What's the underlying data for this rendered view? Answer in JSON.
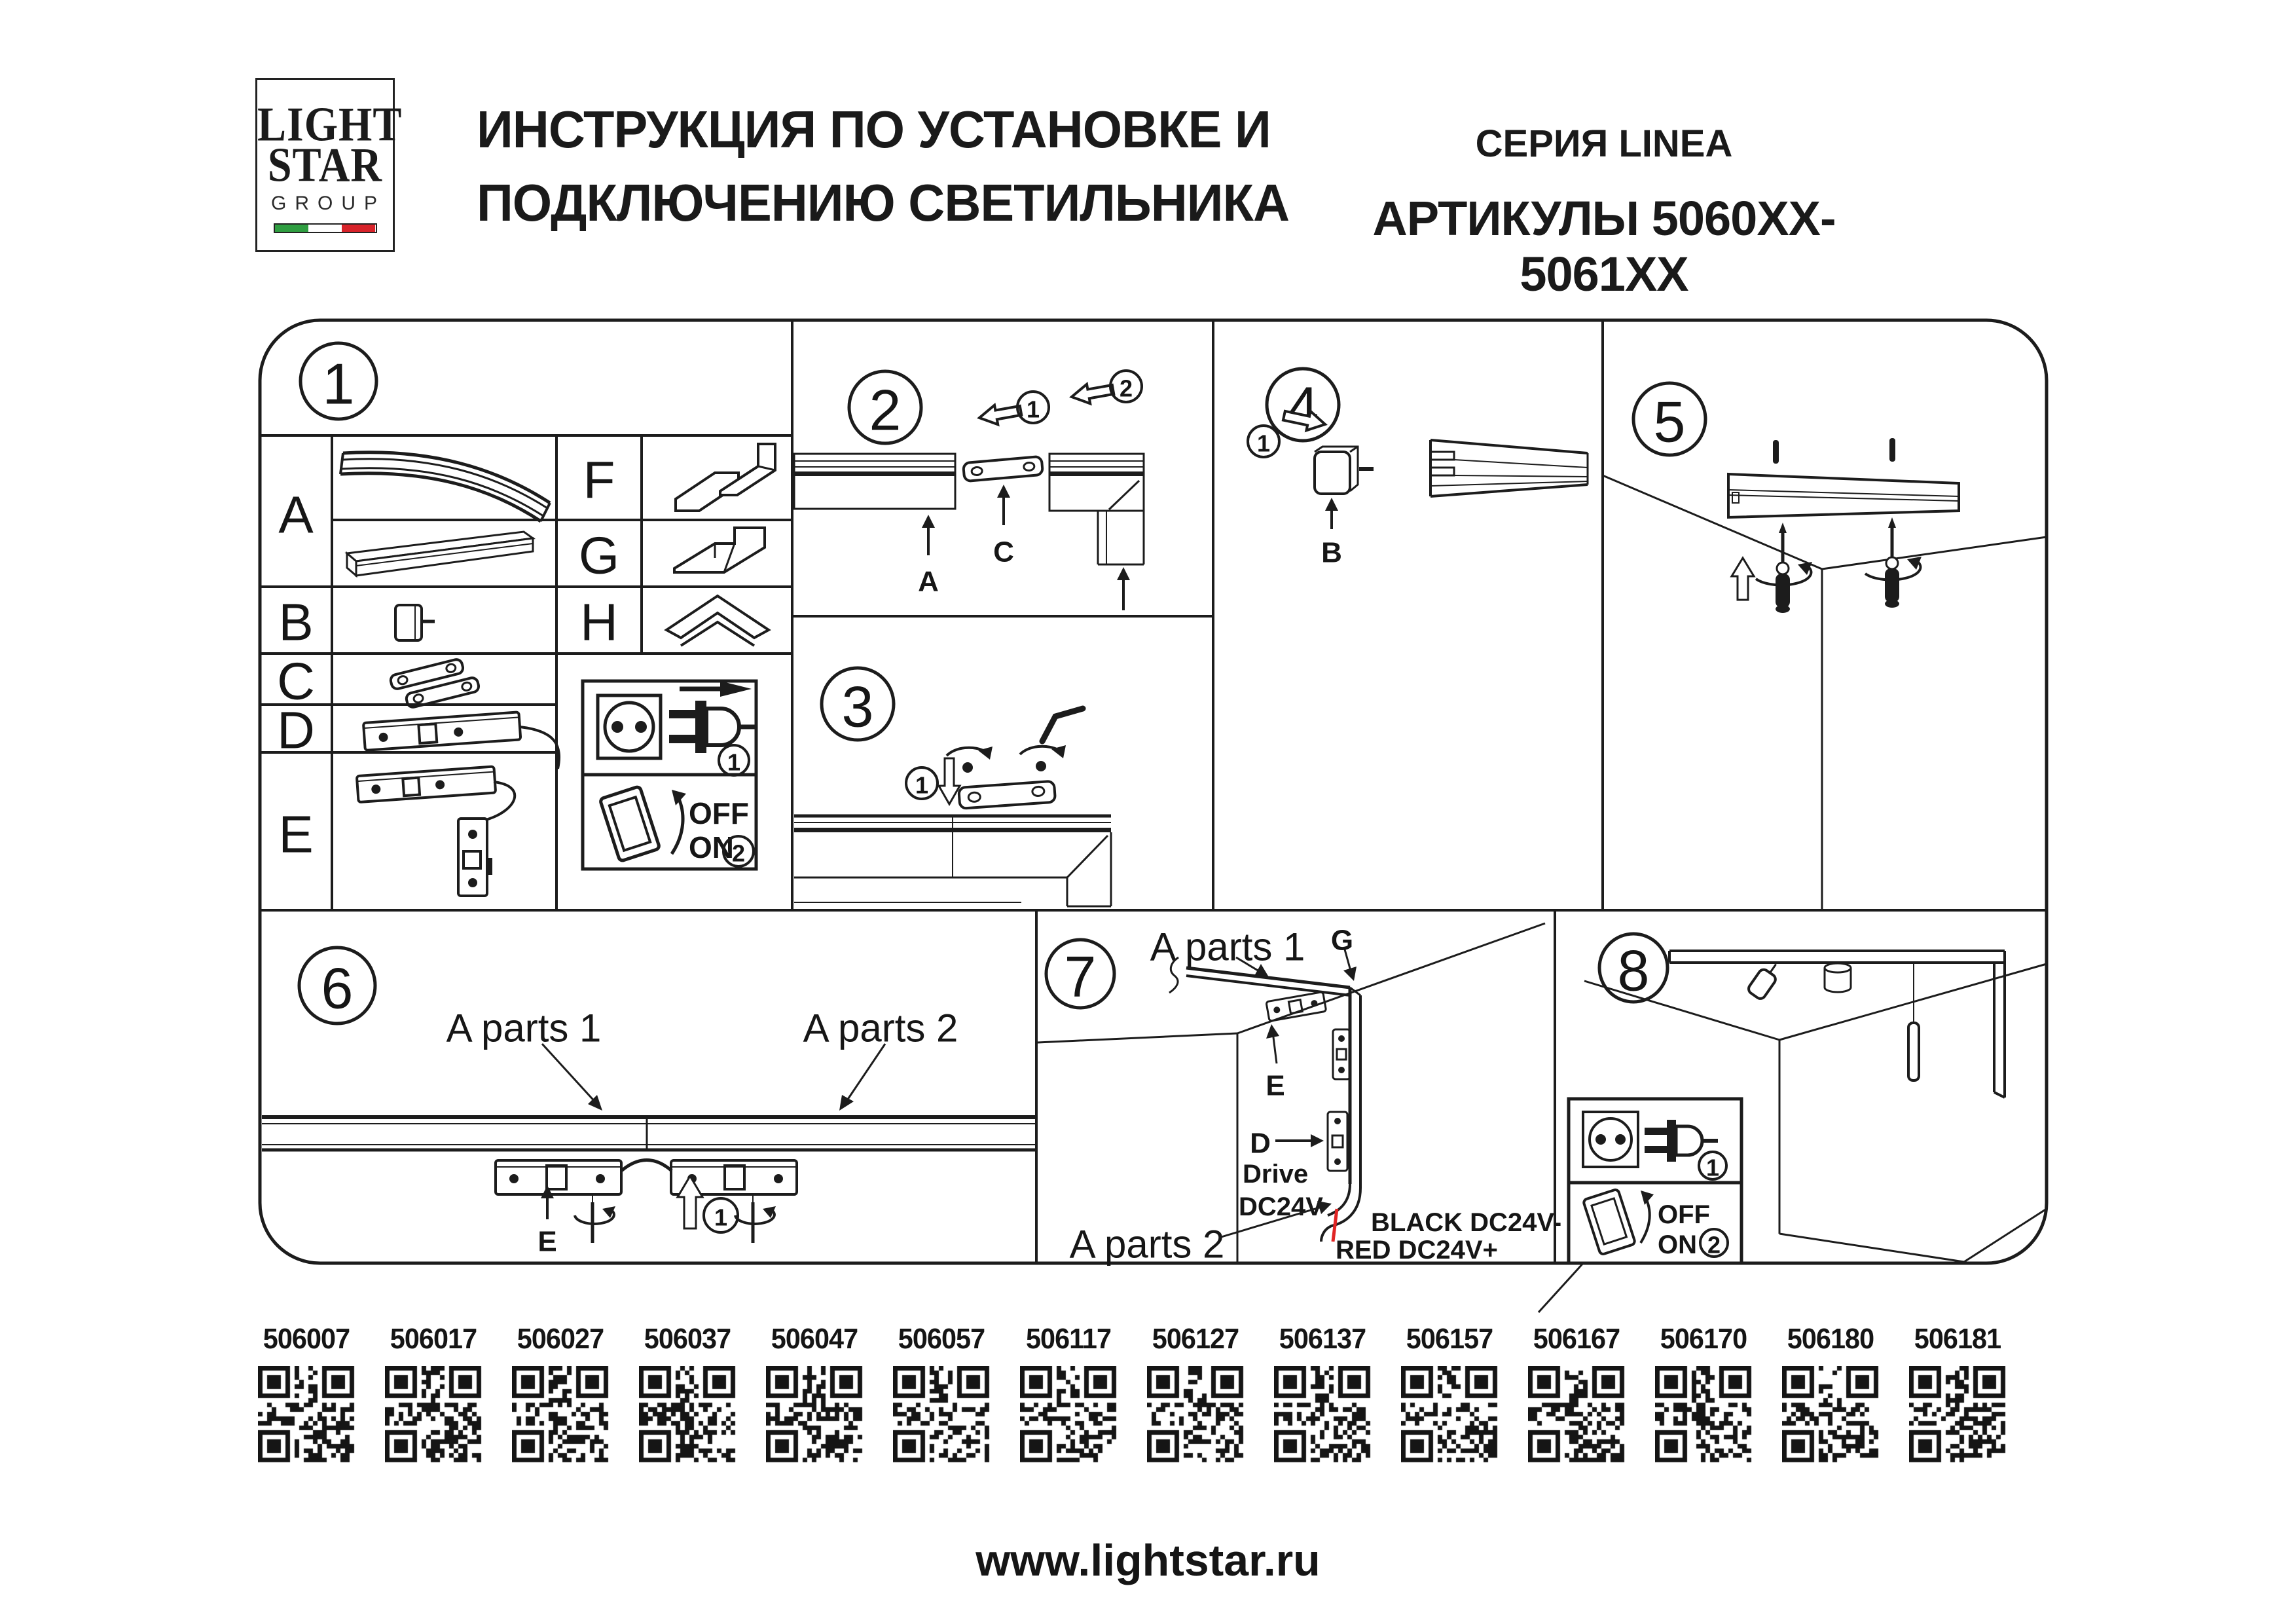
{
  "header": {
    "logo": {
      "line1": "LIGHT",
      "line2": "STAR",
      "line3": "GROUP"
    },
    "title_line1": "ИНСТРУКЦИЯ ПО УСТАНОВКЕ И",
    "title_line2": "ПОДКЛЮЧЕНИЮ СВЕТИЛЬНИКА",
    "series": "СЕРИЯ LINEA",
    "articles": "АРТИКУЛЫ 5060XX-5061XX"
  },
  "colors": {
    "flag_green": "#2f9e41",
    "flag_white": "#ffffff",
    "flag_red": "#d8232a",
    "wire_red": "#e02424"
  },
  "panels": {
    "p1": "1",
    "p2": "2",
    "p3": "3",
    "p4": "4",
    "p5": "5",
    "p6": "6",
    "p7": "7",
    "p8": "8"
  },
  "parts": {
    "left": [
      {
        "letter": "A"
      },
      {
        "letter": "B"
      },
      {
        "letter": "C"
      },
      {
        "letter": "D"
      },
      {
        "letter": "E"
      }
    ],
    "right": [
      {
        "letter": "F"
      },
      {
        "letter": "G"
      },
      {
        "letter": "H"
      }
    ]
  },
  "steps": {
    "one": "1",
    "two": "2"
  },
  "power": {
    "off": "OFF",
    "on": "ON"
  },
  "labels": {
    "a": "A",
    "b": "B",
    "c": "C",
    "d": "D",
    "e": "E",
    "g": "G",
    "a_parts_1": "A parts 1",
    "a_parts_2": "A parts 2",
    "drive_line1": "Drive",
    "drive_line2": "DC24V",
    "black_wire": "BLACK DC24V-",
    "red_wire": "RED DC24V+"
  },
  "qr": {
    "items": [
      "506007",
      "506017",
      "506027",
      "506037",
      "506047",
      "506057",
      "506117",
      "506127",
      "506137",
      "506157",
      "506167",
      "506170",
      "506180",
      "506181"
    ]
  },
  "footer": {
    "url": "www.lightstar.ru"
  }
}
